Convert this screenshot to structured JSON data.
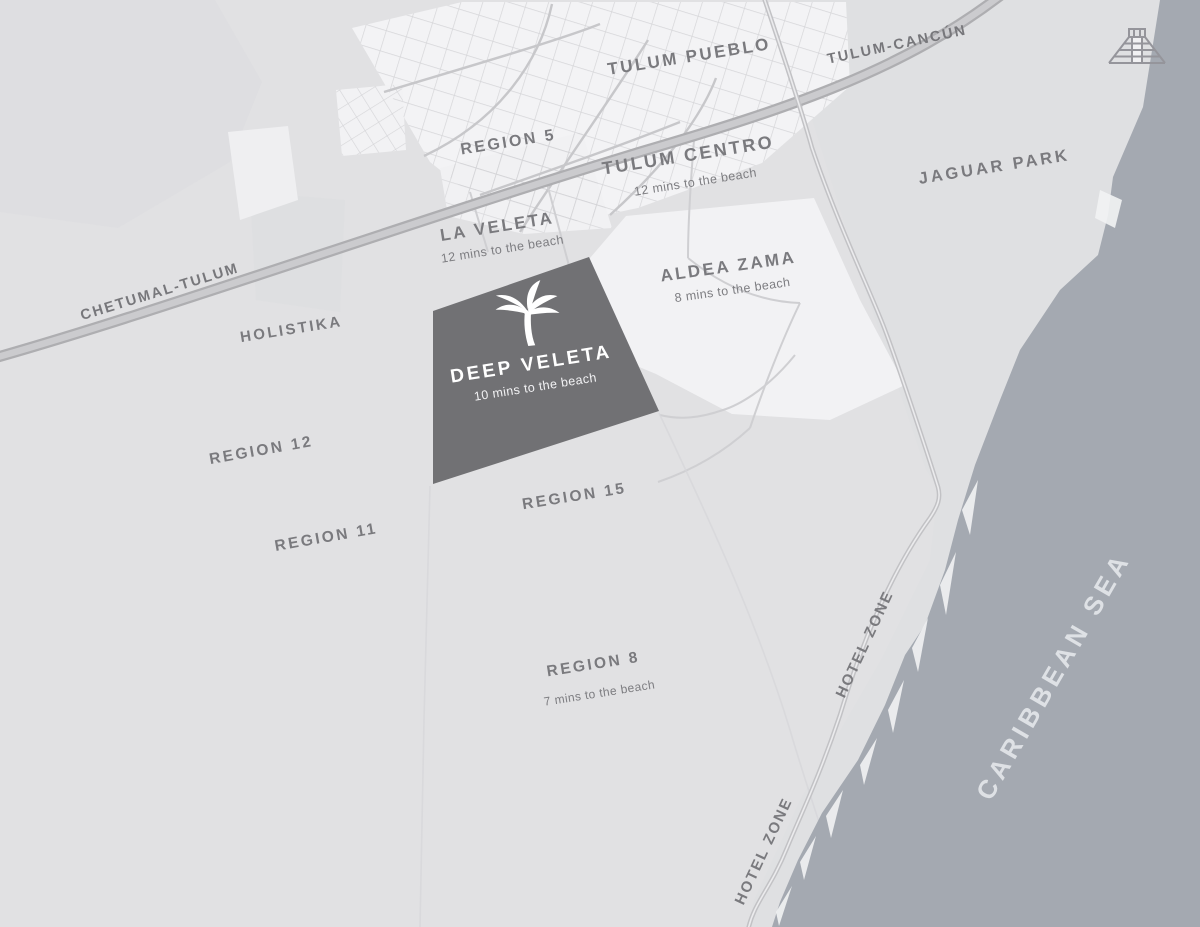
{
  "map": {
    "name": "Tulum area map with Deep Veleta development highlighted",
    "labels": {
      "region_5": {
        "text": "REGION 5"
      },
      "tulum_pueblo": {
        "text": "TULUM PUEBLO"
      },
      "tulum_centro": {
        "text": "TULUM CENTRO",
        "subtitle": "12 mins to the beach"
      },
      "la_veleta": {
        "text": "LA VELETA",
        "subtitle": "12 mins to the beach"
      },
      "aldea_zama": {
        "text": "ALDEA ZAMA",
        "subtitle": "8 mins to the beach"
      },
      "jaguar_park": {
        "text": "JAGUAR PARK"
      },
      "holistika": {
        "text": "HOLISTIKA"
      },
      "deep_veleta": {
        "text": "DEEP VELETA",
        "subtitle": "10 mins to the beach"
      },
      "region_12": {
        "text": "REGION 12"
      },
      "region_11": {
        "text": "REGION 11"
      },
      "region_15": {
        "text": "REGION 15"
      },
      "region_8": {
        "text": "REGION 8",
        "subtitle": "7 mins to the beach"
      },
      "hotel_zone_north": {
        "text": "HOTEL ZONE"
      },
      "hotel_zone_south": {
        "text": "HOTEL ZONE"
      },
      "caribbean_sea": {
        "text": "CARIBBEAN SEA"
      },
      "road_chetumal": {
        "text": "CHETUMAL-TULUM"
      },
      "road_cancun": {
        "text": "TULUM-CANCÚN"
      }
    },
    "icons": {
      "palm": "palm-tree-icon",
      "pyramid": "mayan-pyramid-icon"
    },
    "colors": {
      "land": "#e1e1e3",
      "land_east": "#dfe0e2",
      "town": "#f3f3f5",
      "sea": "#a4a9b1",
      "highlight_parcel": "#717174",
      "highway": "#b0b0b3",
      "highway_center": "#cbcbce",
      "minor_road": "#c9c9cc",
      "street_grid": "#d2d2d5",
      "label_text": "#7a7a7e",
      "sea_label_text": "#dee1e5",
      "white": "#ffffff"
    }
  }
}
